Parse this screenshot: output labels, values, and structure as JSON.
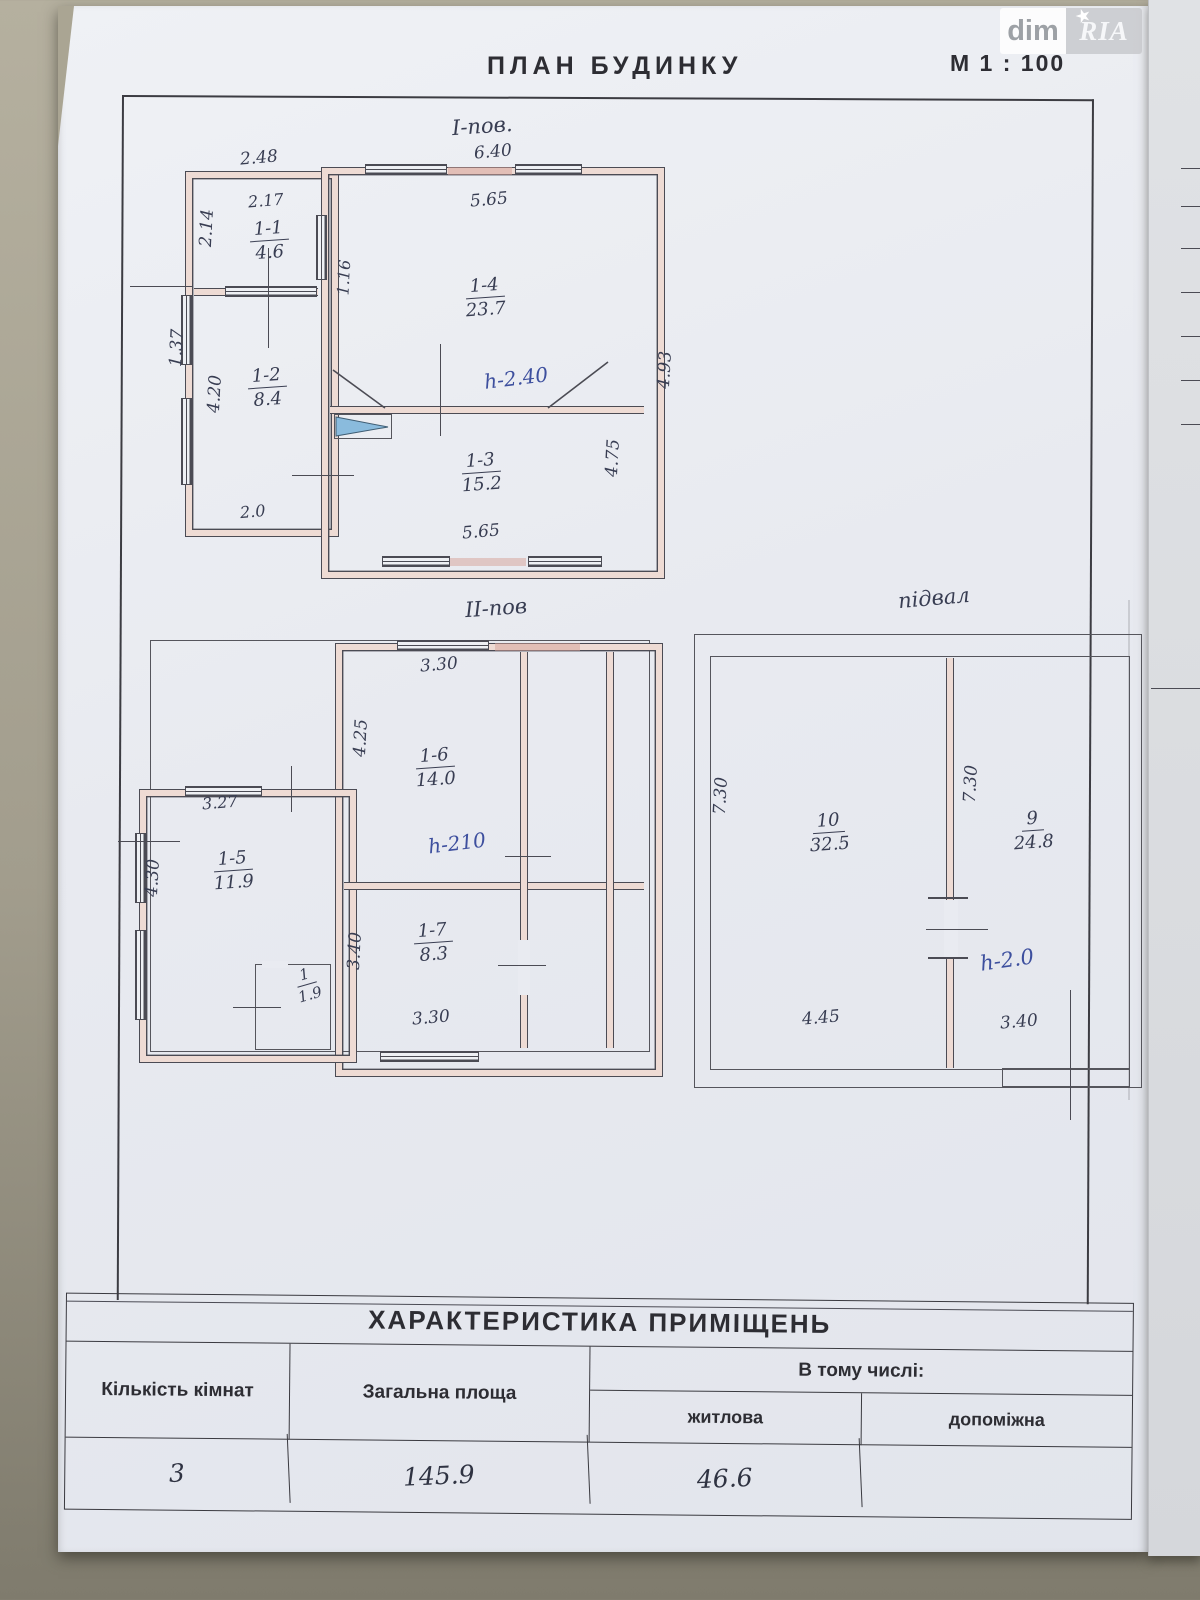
{
  "watermark": {
    "left": "dim",
    "right": "RIA",
    "star_icon": "★"
  },
  "header": {
    "title": "ПЛАН  БУДИНКУ",
    "scale": "М  1 : 100"
  },
  "floor1": {
    "title": "І-пов.",
    "height_note": "h-2.40",
    "dims": {
      "top_width": "6.40",
      "top_left": "2.48",
      "annex_top": "2.17",
      "annex_left": "2.14",
      "hall": "1.16",
      "main_top": "5.65",
      "right_outer": "4.93",
      "right_inner": "4.75",
      "left_outer": "1.37",
      "left_inner": "4.20",
      "bottom_left": "2.0",
      "bottom": "5.65"
    },
    "rooms": {
      "r11": {
        "num": "1-1",
        "area": "4.6"
      },
      "r12": {
        "num": "1-2",
        "area": "8.4"
      },
      "r13": {
        "num": "1-3",
        "area": "15.2"
      },
      "r14": {
        "num": "1-4",
        "area": "23.7"
      }
    }
  },
  "floor2": {
    "title": "ІІ-пов",
    "height_note": "h-210",
    "dims": {
      "top": "3.30",
      "left_inner": "4.25",
      "terrace": "3.27",
      "left_outer": "4.30",
      "small_v": "3.40",
      "bottom": "3.30"
    },
    "rooms": {
      "r16": {
        "num": "1-6",
        "area": "14.0"
      },
      "r15": {
        "num": "1-5",
        "area": "11.9"
      },
      "r17": {
        "num": "1-7",
        "area": "8.3"
      },
      "r1": {
        "num": "1",
        "area": "1.9"
      }
    }
  },
  "basement": {
    "title": "підвал",
    "height_note": "h-2.0",
    "dims": {
      "left": "7.30",
      "mid": "7.30",
      "bottom_left": "4.45",
      "bottom_right": "3.40"
    },
    "rooms": {
      "r10": {
        "num": "10",
        "area": "32.5"
      },
      "r9": {
        "num": "9",
        "area": "24.8"
      }
    }
  },
  "table": {
    "title": "ХАРАКТЕРИСТИКА   ПРИМІЩЕНЬ",
    "columns": {
      "rooms": "Кількість кімнат",
      "total": "Загальна площа",
      "including": "В тому числі:",
      "living": "житлова",
      "auxiliary": "допоміжна"
    },
    "values": {
      "rooms": "3",
      "total": "145.9",
      "living": "46.6",
      "auxiliary": ""
    }
  },
  "colors": {
    "paper": "#e9ebf1",
    "desk": "#a29d8d",
    "wall_fill": "#eedbd4",
    "ink": "#383d52",
    "ink_blue": "#3d4f9e"
  }
}
